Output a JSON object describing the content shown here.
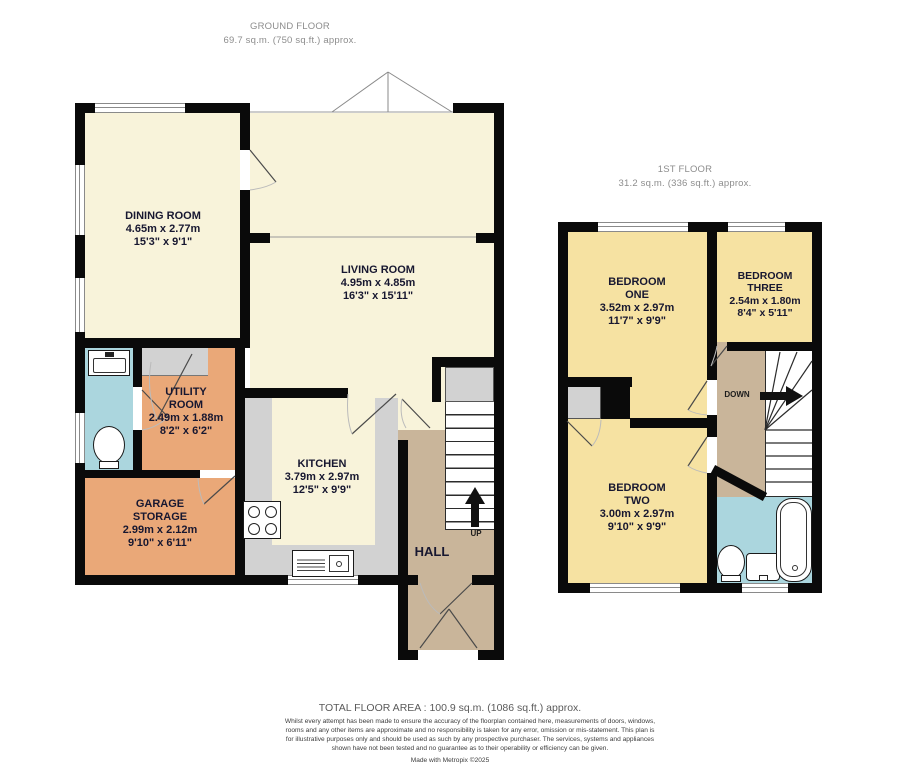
{
  "colors": {
    "cream": "#f8f3da",
    "bedroom": "#f6e2a2",
    "hall": "#c9b59a",
    "utility": "#eaa878",
    "bath": "#abd6de",
    "cupboard": "#d2d2d2",
    "wall": "#0a0a0a"
  },
  "ground_floor": {
    "title": "GROUND FLOOR",
    "area": "69.7 sq.m. (750 sq.ft.) approx.",
    "rooms": {
      "dining": {
        "name": "DINING ROOM",
        "metric": "4.65m  x 2.77m",
        "imperial": "15'3\"  x 9'1\""
      },
      "living": {
        "name": "LIVING ROOM",
        "metric": "4.95m  x 4.85m",
        "imperial": "16'3\"  x 15'11\""
      },
      "utility": {
        "name": "UTILITY ROOM",
        "metric": "2.49m  x 1.88m",
        "imperial": "8'2\"  x 6'2\""
      },
      "garage": {
        "name": "GARAGE STORAGE",
        "metric": "2.99m  x 2.12m",
        "imperial": "9'10\"  x 6'11\""
      },
      "kitchen": {
        "name": "KITCHEN",
        "metric": "3.79m  x 2.97m",
        "imperial": "12'5\"  x 9'9\""
      },
      "hall": {
        "name": "HALL"
      }
    },
    "stairs_label": "UP"
  },
  "first_floor": {
    "title": "1ST FLOOR",
    "area": "31.2 sq.m. (336 sq.ft.) approx.",
    "rooms": {
      "bedroom_one": {
        "name": "BEDROOM ONE",
        "metric": "3.52m  x 2.97m",
        "imperial": "11'7\"  x 9'9\""
      },
      "bedroom_two": {
        "name": "BEDROOM TWO",
        "metric": "3.00m  x 2.97m",
        "imperial": "9'10\"  x 9'9\""
      },
      "bedroom_three": {
        "name": "BEDROOM THREE",
        "metric": "2.54m  x 1.80m",
        "imperial": "8'4\"  x 5'11\""
      }
    },
    "stairs_label": "DOWN"
  },
  "footer": {
    "total": "TOTAL FLOOR AREA : 100.9 sq.m. (1086 sq.ft.) approx.",
    "disclaimer": "Whilst every attempt has been made to ensure the accuracy of the floorplan contained here, measurements of doors, windows, rooms and any other items are approximate and no responsibility is taken for any error, omission or mis-statement. This plan is for illustrative purposes only and should be used as such by any prospective purchaser. The services, systems and appliances shown have not been tested and no guarantee as to their operability or efficiency can be given.",
    "credit": "Made with Metropix ©2025"
  }
}
